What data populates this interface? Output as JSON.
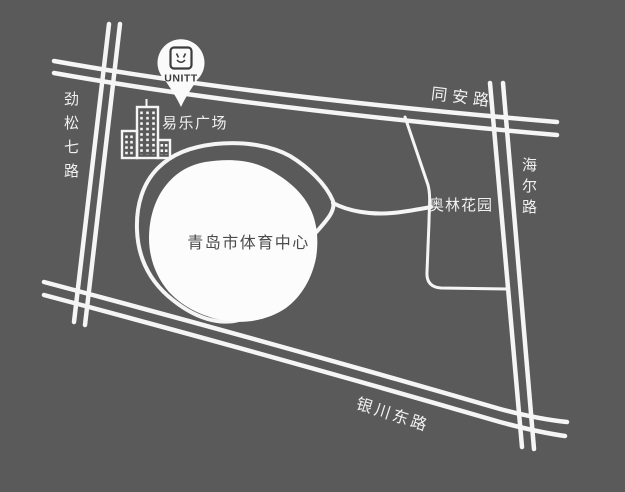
{
  "map": {
    "colors": {
      "background": "#5a5a5a",
      "road": "#f5f5f5",
      "area_fill": "#fcfcfc",
      "area_text": "#4c4c4c",
      "marker_fill": "#fafafa",
      "marker_text": "#3c3c3c"
    },
    "marker": {
      "label": "UNITT",
      "icon": "socket-logo-icon"
    },
    "roads": [
      {
        "id": "jinsong7",
        "name": "劲松七路",
        "orientation": "vertical",
        "style": "double-line"
      },
      {
        "id": "tongan",
        "name": "同安路",
        "orientation": "horizontal",
        "style": "double-line"
      },
      {
        "id": "haier",
        "name": "海尔路",
        "orientation": "vertical",
        "style": "double-line"
      },
      {
        "id": "yinchuan_east",
        "name": "银川东路",
        "orientation": "diagonal",
        "style": "double-line"
      }
    ],
    "places": [
      {
        "id": "yile_plaza",
        "name": "易乐广场",
        "icon": "buildings-icon"
      },
      {
        "id": "aolin_garden",
        "name": "奥林花园"
      },
      {
        "id": "sports_center",
        "name": "青岛市体育中心",
        "shape": "white-blob"
      }
    ]
  }
}
